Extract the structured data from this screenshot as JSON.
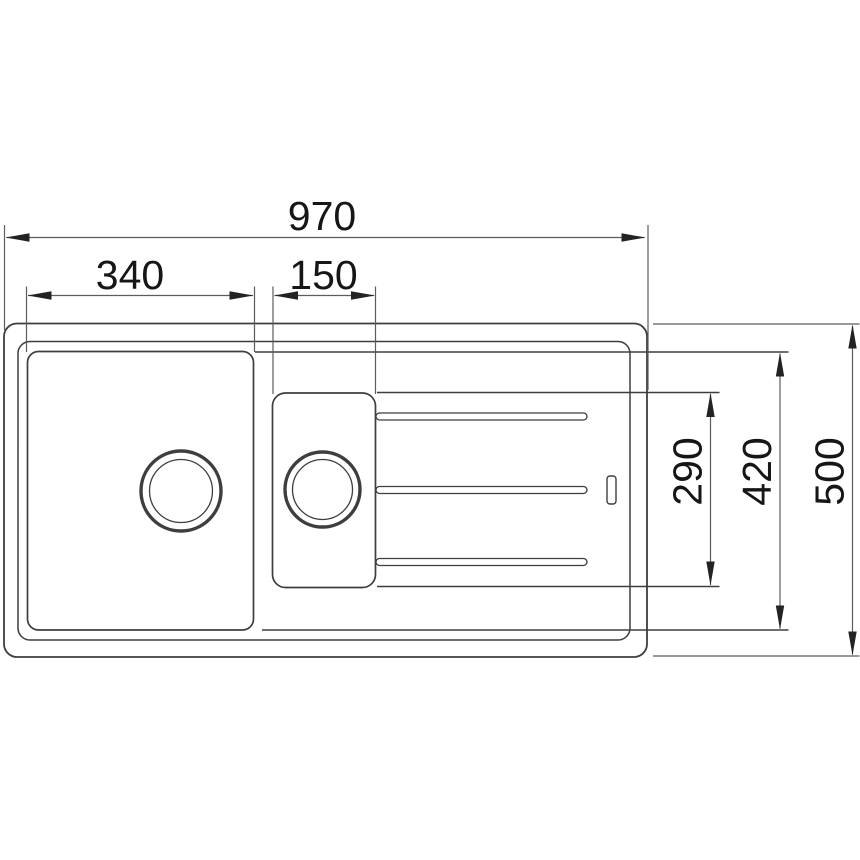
{
  "colors": {
    "background": "#ffffff",
    "outline": "#3e3e3e",
    "dimension_line": "#5c5c5c",
    "arrowhead": "#232323",
    "label_text": "#161616"
  },
  "dimensions": {
    "overall_width": "970",
    "main_bowl_width": "340",
    "half_bowl_width": "150",
    "drainer_recess_depth": "290",
    "bowl_depth": "420",
    "overall_depth": "500"
  }
}
